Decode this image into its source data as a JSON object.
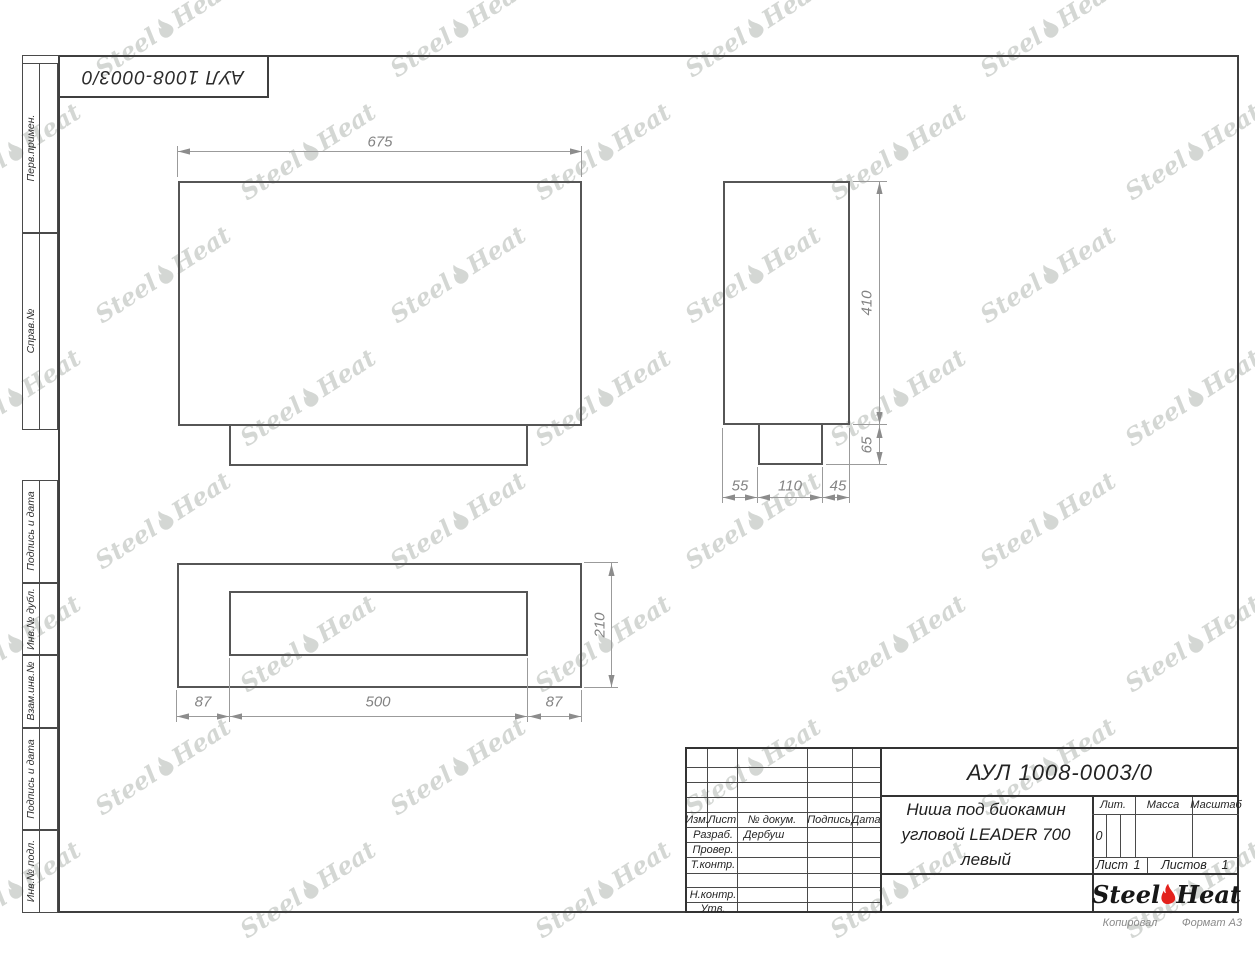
{
  "sheet": {
    "copied_note": "Копировал",
    "format_note": "Формат А3"
  },
  "stamp_top": {
    "doc_number": "АУЛ 1008-0003/0"
  },
  "margin_labels": [
    "Перв.примен.",
    "Справ.№",
    "Подпись и дата",
    "Инв.№ дубл.",
    "Взам.инв.№",
    "Подпись и дата",
    "Инв.№ подл."
  ],
  "drawing": {
    "front_view": {
      "width": "675"
    },
    "side_view": {
      "height": "410",
      "base_height": "65",
      "bottom": [
        "55",
        "110",
        "45"
      ]
    },
    "plan_view": {
      "depth": "210",
      "bottom": [
        "87",
        "500",
        "87"
      ]
    }
  },
  "title_block": {
    "doc_number": "АУЛ 1008-0003/0",
    "product_title_lines": [
      "Ниша под биокамин",
      "угловой LEADER 700",
      "левый"
    ],
    "header_cells": [
      "Изм.",
      "Лист",
      "№ докум.",
      "Подпись",
      "Дата"
    ],
    "signature_rows": [
      {
        "label": "Разраб.",
        "name": "Дербуш"
      },
      {
        "label": "Провер.",
        "name": ""
      },
      {
        "label": "Т.контр.",
        "name": ""
      },
      {
        "label": "Н.контр.",
        "name": ""
      },
      {
        "label": "Утв.",
        "name": ""
      }
    ],
    "lit_label": "Лит.",
    "lit_value": "0",
    "mass_label": "Масса",
    "scale_label": "Масштаб",
    "sheet_label": "Лист",
    "sheet_value": "1",
    "sheets_label": "Листов",
    "sheets_value": "1",
    "logo": {
      "word1": "Steel",
      "word2": "Heat",
      "flame_color": "#e3211c"
    }
  },
  "watermark": {
    "word1": "Steel",
    "word2": "Heat"
  }
}
